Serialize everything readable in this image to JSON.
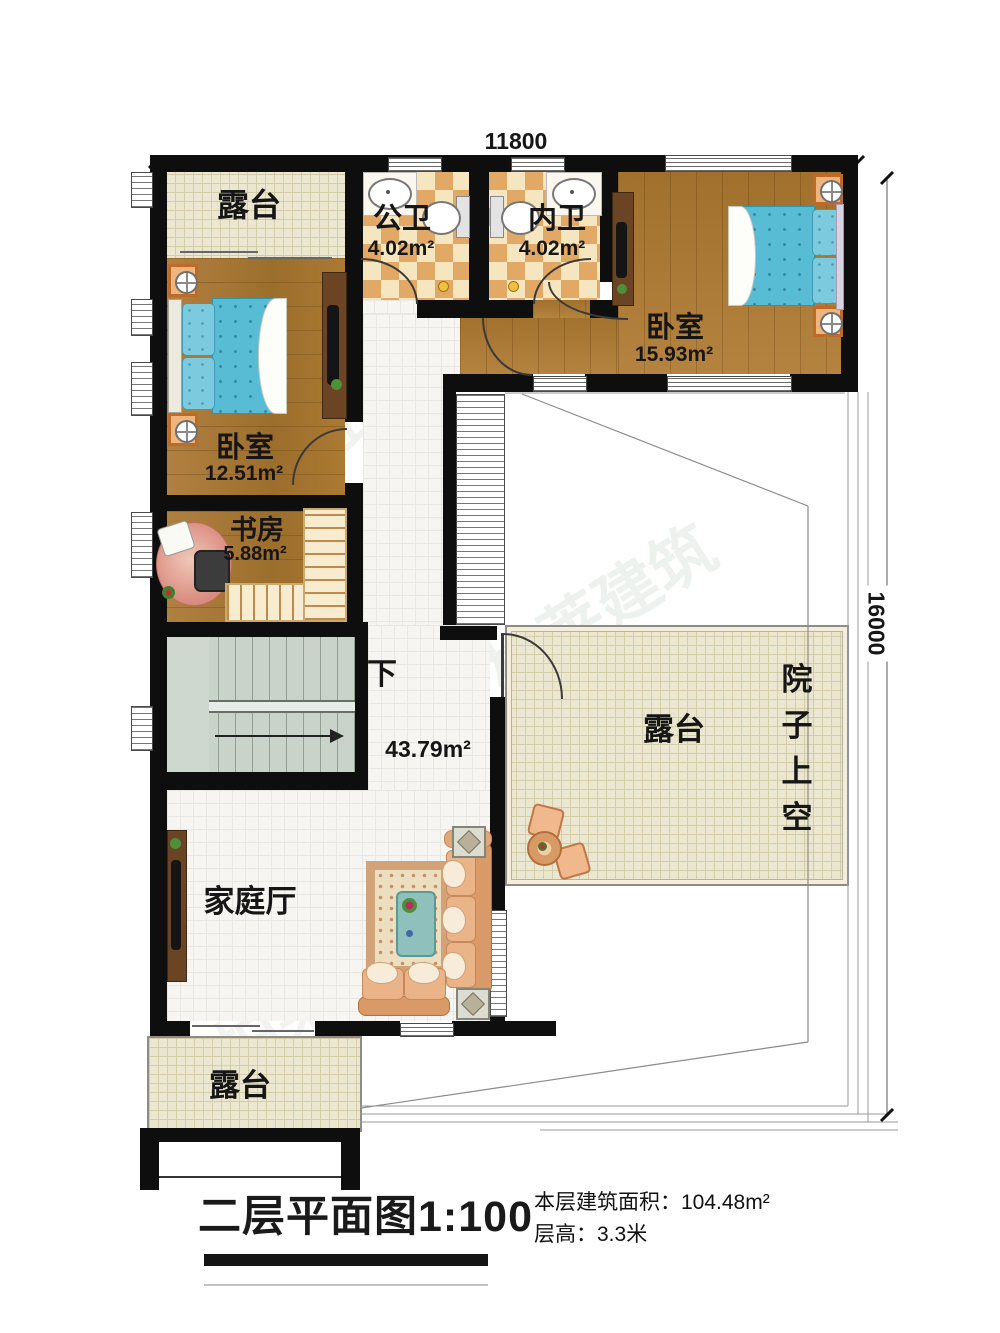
{
  "dimensions": {
    "top": "11800",
    "right": "16000"
  },
  "rooms": {
    "terrace_top": {
      "label": "露台"
    },
    "public_bath": {
      "label": "公卫",
      "area": "4.02m²"
    },
    "private_bath": {
      "label": "内卫",
      "area": "4.02m²"
    },
    "bedroom_right": {
      "label": "卧室",
      "area": "15.93m²"
    },
    "bedroom_left": {
      "label": "卧室",
      "area": "12.51m²"
    },
    "study": {
      "label": "书房",
      "area": "5.88m²"
    },
    "hall": {
      "area": "43.79m²",
      "down_label": "下"
    },
    "family_room": {
      "label": "家庭厅"
    },
    "terrace_middle": {
      "label": "露台"
    },
    "terrace_bottom": {
      "label": "露台"
    },
    "courtyard": {
      "label": "院子上空",
      "chars": [
        "院",
        "子",
        "上",
        "空"
      ]
    }
  },
  "footer": {
    "title": "二层平面图1:100",
    "area_info": "本层建筑面积：104.48m²",
    "height_info": "层高：3.3米"
  },
  "colors": {
    "wall": "#0e0e0e",
    "wood": "#a9782f",
    "bath_tile_dark": "#e2a966",
    "terrace_tile": "#ebe6cf",
    "stair": "#c9d3c9",
    "bed_blue": "#58bcd4",
    "sofa": "#eab488",
    "table_teal": "#8fc0bc",
    "nightstand_orange": "#efb57e"
  },
  "watermark": {
    "text": "柏莱建筑"
  }
}
